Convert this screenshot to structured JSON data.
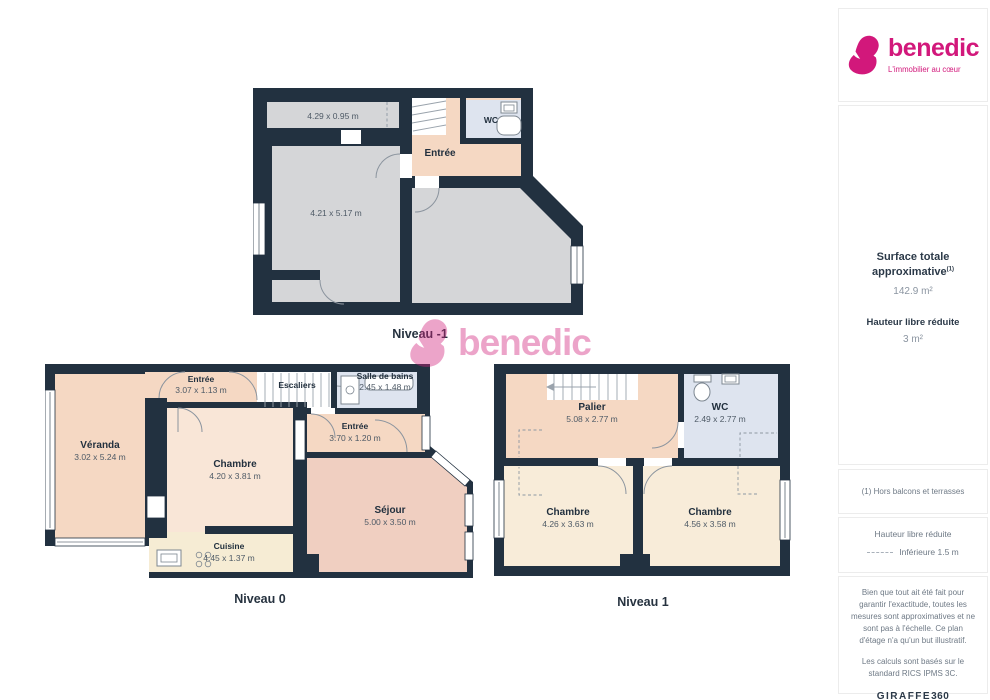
{
  "brand": {
    "name": "benedic",
    "tagline": "L'immobilier au cœur",
    "color": "#d2187b"
  },
  "sidebar": {
    "surface_label": "Surface totale approximative",
    "surface_sup": "(1)",
    "surface_value": "142.9 m²",
    "height_label": "Hauteur libre réduite",
    "height_value": "3 m²",
    "note": "(1) Hors balcons et terrasses",
    "legend_title": "Hauteur libre réduite",
    "legend_item": "Inférieure 1.5 m",
    "disclaimer_1": "Bien que tout ait été fait pour garantir l'exactitude, toutes les mesures sont approximatives et ne sont pas à l'échelle. Ce plan d'étage n'a qu'un but illustratif.",
    "disclaimer_2": "Les calculs sont basés sur le standard RICS IPMS 3C.",
    "provider": "GIRAFFE",
    "provider_suffix": "360"
  },
  "floors": [
    {
      "name": "Niveau -1",
      "rooms": [
        {
          "label": "",
          "dims": "4.29 x 0.95 m"
        },
        {
          "label": "",
          "dims": "4.21 x 5.17 m"
        },
        {
          "label": "Entrée",
          "dims": ""
        },
        {
          "label": "WC",
          "dims": ""
        }
      ]
    },
    {
      "name": "Niveau 0",
      "rooms": [
        {
          "label": "Véranda",
          "dims": "3.02 x 5.24 m"
        },
        {
          "label": "Entrée",
          "dims": "3.07 x 1.13 m"
        },
        {
          "label": "Escaliers",
          "dims": ""
        },
        {
          "label": "Salle de bains",
          "dims": "2.45 x 1.48 m"
        },
        {
          "label": "Chambre",
          "dims": "4.20 x 3.81 m"
        },
        {
          "label": "Entrée",
          "dims": "3.70 x 1.20 m"
        },
        {
          "label": "Séjour",
          "dims": "5.00 x 3.50 m"
        },
        {
          "label": "Cuisine",
          "dims": "4.45 x 1.37 m"
        }
      ]
    },
    {
      "name": "Niveau 1",
      "rooms": [
        {
          "label": "Palier",
          "dims": "5.08 x 2.77 m"
        },
        {
          "label": "WC",
          "dims": "2.49 x 2.77 m"
        },
        {
          "label": "Chambre",
          "dims": "4.26 x 3.63 m"
        },
        {
          "label": "Chambre",
          "dims": "4.56 x 3.58 m"
        }
      ]
    }
  ],
  "colors": {
    "wall": "#223140",
    "room_gray": "#d5d6d8",
    "room_peach": "#f5d8c3",
    "room_peach_light": "#f9e6d7",
    "room_salmon": "#f0cfc1",
    "room_cream": "#f8edd9",
    "room_blue": "#dee4ef",
    "brand_pink": "#d2187b"
  }
}
